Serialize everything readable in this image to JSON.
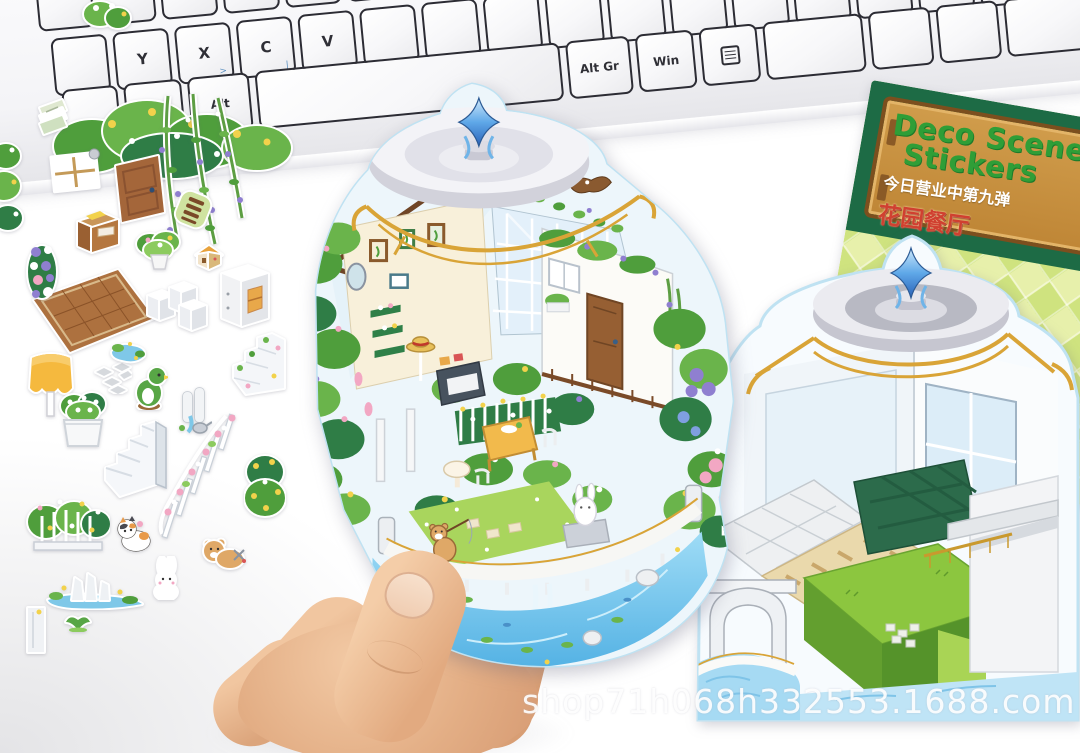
{
  "scene": {
    "watermark": "shop71h068h332553.1688.com",
    "background_color": "#ffffff"
  },
  "keyboard": {
    "letter_keys": [
      "Y",
      "X",
      "C",
      "V"
    ],
    "sub_legends": [
      ">",
      "|"
    ],
    "bottom_keys": {
      "alt": "Alt",
      "space": "",
      "altgr": "Alt Gr",
      "win": "Win"
    },
    "menu_key_icon": "context-menu-icon",
    "key_color": "#ffffff",
    "key_border_color": "#2c2c34"
  },
  "packaging": {
    "title_line1": "Deco Scene",
    "title_line2": "Stickers",
    "subtitle": "今日营业中第九弹",
    "product_name": "花园餐厅",
    "mascot_icon": "cactus-in-pot-icon",
    "colors": {
      "band": "#1d6b45",
      "wood_sign": "#c8903e",
      "title_green": "#2f9e37",
      "subtitle_white": "#ffffff",
      "product_red": "#d04030",
      "checker_light": "#e7f0ab",
      "checker_dark": "#cfe37f",
      "star_yellow": "#f8d33c"
    }
  },
  "held_sticker": {
    "name": "garden-restaurant-dome-scene",
    "features": [
      "crystal-finial",
      "dome-roof",
      "gold-trim",
      "glass-greenhouse",
      "picture-frames",
      "flower-garden",
      "balcony-door",
      "dining-set",
      "white-balustrade",
      "waterfall-pool",
      "bear-fishing",
      "bunny-statue",
      "flying-bird"
    ]
  },
  "base_card": {
    "name": "empty-scene-base",
    "features": [
      "crystal-finial",
      "dome-roof",
      "gold-trim",
      "glass-walls",
      "grass-platform",
      "tan-tile-floor",
      "green-tile-floor",
      "stone-arch",
      "pool",
      "white-terrace"
    ]
  },
  "loose_stickers": [
    "leafy-bush",
    "cut-plant",
    "paper-stack",
    "hanging-vine",
    "window",
    "wood-door",
    "writing-desk",
    "garden-bench",
    "potted-plant",
    "mini-house",
    "white-cabinet",
    "wood-rug",
    "flower-garland",
    "shelf-blocks",
    "flower-stairs",
    "yellow-awning",
    "flower-planter",
    "stepping-stones",
    "pond-piece",
    "topiary",
    "white-staircase",
    "waterfall-rocks",
    "rose-fence",
    "green-bush",
    "flower-fence",
    "calico-cat",
    "white-bunny",
    "teddy-bear",
    "rock-pool",
    "sprout",
    "arch-piece",
    "edge-plant"
  ],
  "hand": {
    "name": "hand-holding-sticker"
  }
}
